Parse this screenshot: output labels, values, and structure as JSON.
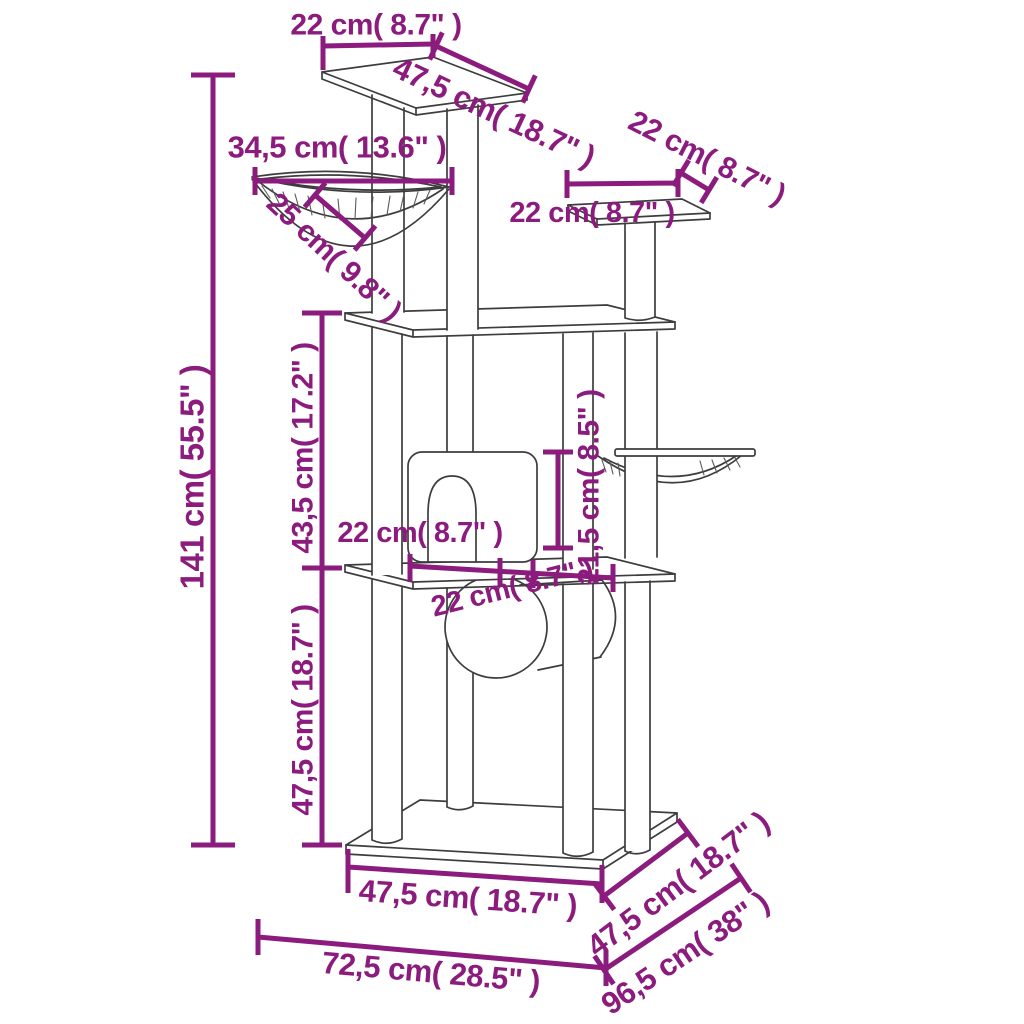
{
  "diagram_title": "Cat tree dimension diagram",
  "colors": {
    "dimension_accent": "#8b1b7d",
    "outline": "#3d3d3d",
    "background": "#ffffff"
  },
  "dims": {
    "top_platform_width": "22 cm( 8.7\" )",
    "top_platform_depth": "47,5 cm( 18.7\" )",
    "right_platform_depth": "22 cm( 8.7\" )",
    "right_platform_width": "22 cm( 8.7\" )",
    "basket_width": "34,5 cm( 13.6\" )",
    "basket_depth": "25 cm( 9.8\" )",
    "total_height": "141 cm( 55.5\" )",
    "middle_section_height": "43,5 cm( 17.2\" )",
    "hammock_height": "21,5 cm( 8.5\" )",
    "house_width": "22 cm( 8.7\" )",
    "house_depth": "22 cm( 8.7\" )",
    "lower_section_height": "47,5 cm( 18.7\" )",
    "base_front_width": "47,5 cm( 18.7\" )",
    "base_side_depth": "47,5 cm( 18.7\" )",
    "footprint_width": "72,5 cm( 28.5\" )",
    "footprint_depth": "96,5 cm( 38\" )"
  }
}
